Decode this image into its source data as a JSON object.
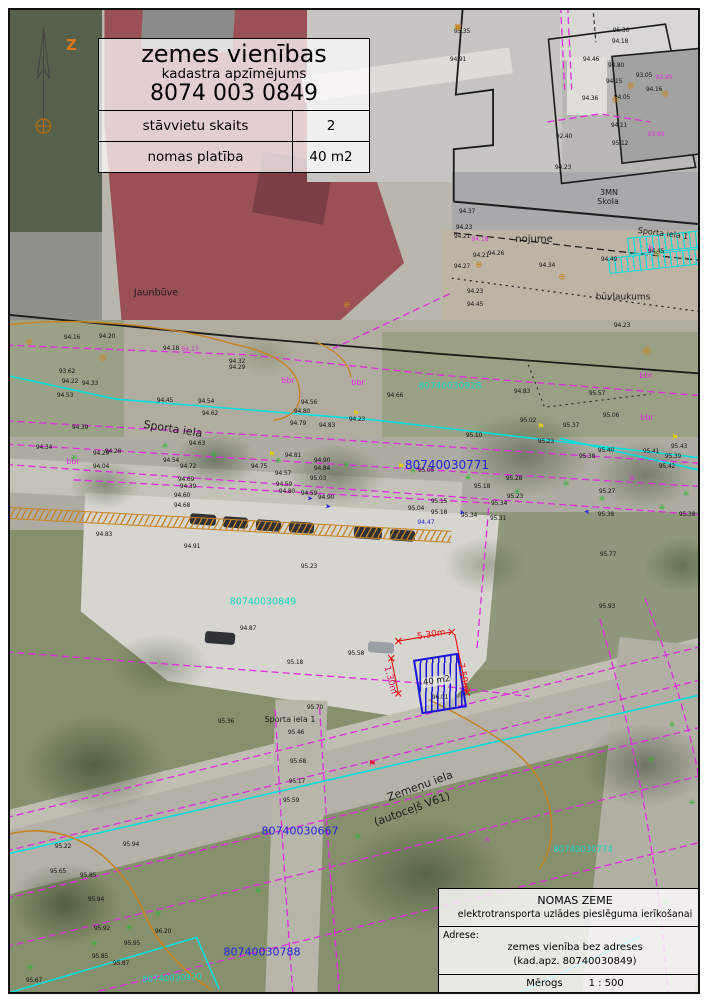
{
  "title_block": {
    "line1": "zemes vienības",
    "line2": "kadastra apzīmējums",
    "line3": "8074 003 0849",
    "rows": [
      {
        "label": "stāvvietu skaits",
        "value": "2"
      },
      {
        "label": "nomas platība",
        "value": "40 m2"
      }
    ]
  },
  "north": {
    "label": "Z"
  },
  "info_block": {
    "title": "NOMAS ZEME",
    "subtitle": "elektrotransporta uzlādes pieslēguma ierīkošanai",
    "address_label": "Adrese:",
    "address_line1": "zemes vienība bez adreses",
    "address_line2": "(kad.apz. 80740030849)",
    "scale_label": "Mērogs",
    "scale_value": "1 : 500"
  },
  "lease_area": {
    "label": "40 m2",
    "dim_top": "5.30m",
    "dim_right": "7.50m",
    "dim_left": "1.30m"
  },
  "colors": {
    "parcel_magenta": "#e02ce0",
    "utility_cyan": "#00dede",
    "contour_orange": "#c8831e",
    "parcel_number_blue": "#2222dd",
    "parcel_number_cyan": "#12d8c8",
    "dimension_red": "#ee1111",
    "lease_blue": "#1616dd",
    "tree_green": "#28b828",
    "north_orange": "#e07818"
  },
  "icons": {
    "tree": "✳",
    "manhole": "⊕",
    "utility_box": "▣",
    "lamp": "⚑",
    "arrow": "➤",
    "hydrant": "⚑"
  },
  "map": {
    "street_labels": [
      {
        "t": "Jaunbūve",
        "x": 146,
        "y": 283,
        "size": 9.5
      },
      {
        "t": "nojume",
        "x": 524,
        "y": 230,
        "size": 10
      },
      {
        "t": "3MN",
        "x": 599,
        "y": 183,
        "size": 8
      },
      {
        "t": "Skola",
        "x": 598,
        "y": 192,
        "size": 8
      },
      {
        "t": "Sporta iela 1",
        "x": 653,
        "y": 224,
        "size": 8,
        "rot": 7
      },
      {
        "t": "būvlaukums",
        "x": 613,
        "y": 288,
        "size": 9
      },
      {
        "t": "Sporta iela",
        "x": 163,
        "y": 419,
        "size": 11,
        "rot": 9
      },
      {
        "t": "Sporta iela 1",
        "x": 280,
        "y": 710,
        "size": 8
      },
      {
        "t": "Zemeņu iela",
        "x": 410,
        "y": 776,
        "size": 11,
        "rot": -20
      },
      {
        "t": "(autoceļš V61)",
        "x": 402,
        "y": 799,
        "size": 11,
        "rot": -20
      }
    ],
    "blue_parcel_numbers": [
      {
        "t": "80740030771",
        "x": 437,
        "y": 455,
        "size": 12
      },
      {
        "t": "80740030667",
        "x": 290,
        "y": 821,
        "size": 11
      },
      {
        "t": "80740030788",
        "x": 252,
        "y": 942,
        "size": 11
      }
    ],
    "cyan_parcel_numbers": [
      {
        "t": "80740030928",
        "x": 440,
        "y": 377
      },
      {
        "t": "80740030849",
        "x": 253,
        "y": 592,
        "size": 9.5
      },
      {
        "t": "80740030774",
        "x": 573,
        "y": 840,
        "size": 8.5
      },
      {
        "t": "80740030930",
        "x": 162,
        "y": 969,
        "size": 8.5,
        "rot": -3
      }
    ],
    "magenta_notes": [
      {
        "t": "bbr",
        "x": 278,
        "y": 371
      },
      {
        "t": "bbr",
        "x": 348,
        "y": 373
      },
      {
        "t": "bbr",
        "x": 636,
        "y": 366
      },
      {
        "t": "bbr",
        "x": 637,
        "y": 408
      },
      {
        "t": "bbr",
        "x": 63,
        "y": 452
      },
      {
        "t": "b",
        "x": 641,
        "y": 239
      },
      {
        "t": "a",
        "x": 622,
        "y": 468
      },
      {
        "t": "a",
        "x": 477,
        "y": 830
      },
      {
        "t": "94.17",
        "x": 180,
        "y": 340,
        "size": 6
      },
      {
        "t": "94.18",
        "x": 470,
        "y": 230,
        "size": 6
      },
      {
        "t": "93.99",
        "x": 646,
        "y": 125,
        "size": 6
      },
      {
        "t": "92.95",
        "x": 654,
        "y": 68,
        "size": 6
      }
    ],
    "blue_notes": [
      {
        "t": "94.47",
        "x": 416,
        "y": 513
      }
    ],
    "elevations": [
      {
        "t": "95.35",
        "x": 452,
        "y": 22
      },
      {
        "t": "94.91",
        "x": 448,
        "y": 50
      },
      {
        "t": "95.36",
        "x": 611,
        "y": 21
      },
      {
        "t": "94.18",
        "x": 610,
        "y": 32
      },
      {
        "t": "94.46",
        "x": 581,
        "y": 50
      },
      {
        "t": "94.80",
        "x": 606,
        "y": 56
      },
      {
        "t": "94.15",
        "x": 604,
        "y": 72
      },
      {
        "t": "93.05",
        "x": 634,
        "y": 66
      },
      {
        "t": "94.16",
        "x": 644,
        "y": 80
      },
      {
        "t": "94.05",
        "x": 612,
        "y": 88
      },
      {
        "t": "94.36",
        "x": 580,
        "y": 89
      },
      {
        "t": "94.11",
        "x": 609,
        "y": 116
      },
      {
        "t": "95.12",
        "x": 610,
        "y": 134
      },
      {
        "t": "92.40",
        "x": 554,
        "y": 127
      },
      {
        "t": "94.23",
        "x": 553,
        "y": 158
      },
      {
        "t": "94.37",
        "x": 457,
        "y": 202
      },
      {
        "t": "94.23",
        "x": 454,
        "y": 218
      },
      {
        "t": "94.21",
        "x": 452,
        "y": 227
      },
      {
        "t": "94.27",
        "x": 452,
        "y": 257
      },
      {
        "t": "94.21",
        "x": 471,
        "y": 246
      },
      {
        "t": "94.26",
        "x": 486,
        "y": 244
      },
      {
        "t": "94.34",
        "x": 537,
        "y": 256
      },
      {
        "t": "94.49",
        "x": 599,
        "y": 250
      },
      {
        "t": "94.45",
        "x": 646,
        "y": 242
      },
      {
        "t": "94.23",
        "x": 465,
        "y": 282
      },
      {
        "t": "94.45",
        "x": 465,
        "y": 295
      },
      {
        "t": "94.23",
        "x": 612,
        "y": 316
      },
      {
        "t": "94.16",
        "x": 62,
        "y": 328
      },
      {
        "t": "94.20",
        "x": 97,
        "y": 327
      },
      {
        "t": "94.18",
        "x": 161,
        "y": 339
      },
      {
        "t": "94.32",
        "x": 227,
        "y": 352
      },
      {
        "t": "94.29",
        "x": 227,
        "y": 358
      },
      {
        "t": "93.62",
        "x": 57,
        "y": 362
      },
      {
        "t": "94.22",
        "x": 60,
        "y": 372
      },
      {
        "t": "94.33",
        "x": 80,
        "y": 374
      },
      {
        "t": "94.53",
        "x": 55,
        "y": 386
      },
      {
        "t": "94.39",
        "x": 70,
        "y": 418
      },
      {
        "t": "94.34",
        "x": 34,
        "y": 438
      },
      {
        "t": "94.29",
        "x": 91,
        "y": 444
      },
      {
        "t": "94.28",
        "x": 103,
        "y": 442
      },
      {
        "t": "94.04",
        "x": 91,
        "y": 457
      },
      {
        "t": "94.45",
        "x": 155,
        "y": 391
      },
      {
        "t": "94.54",
        "x": 196,
        "y": 392
      },
      {
        "t": "94.62",
        "x": 200,
        "y": 404
      },
      {
        "t": "94.56",
        "x": 299,
        "y": 393
      },
      {
        "t": "94.80",
        "x": 292,
        "y": 402
      },
      {
        "t": "94.79",
        "x": 288,
        "y": 414
      },
      {
        "t": "94.83",
        "x": 317,
        "y": 416
      },
      {
        "t": "94.23",
        "x": 347,
        "y": 410
      },
      {
        "t": "94.63",
        "x": 187,
        "y": 434
      },
      {
        "t": "94.54",
        "x": 161,
        "y": 451
      },
      {
        "t": "94.72",
        "x": 178,
        "y": 457
      },
      {
        "t": "94.75",
        "x": 249,
        "y": 457
      },
      {
        "t": "94.81",
        "x": 283,
        "y": 446
      },
      {
        "t": "94.90",
        "x": 312,
        "y": 451
      },
      {
        "t": "94.84",
        "x": 312,
        "y": 459
      },
      {
        "t": "94.57",
        "x": 273,
        "y": 464
      },
      {
        "t": "95.03",
        "x": 308,
        "y": 469
      },
      {
        "t": "94.59",
        "x": 274,
        "y": 475
      },
      {
        "t": "94.69",
        "x": 176,
        "y": 470
      },
      {
        "t": "94.39",
        "x": 178,
        "y": 477
      },
      {
        "t": "94.60",
        "x": 172,
        "y": 486
      },
      {
        "t": "94.80",
        "x": 277,
        "y": 482
      },
      {
        "t": "94.59",
        "x": 299,
        "y": 484
      },
      {
        "t": "94.90",
        "x": 316,
        "y": 488
      },
      {
        "t": "94.68",
        "x": 172,
        "y": 496
      },
      {
        "t": "94.66",
        "x": 385,
        "y": 386
      },
      {
        "t": "94.83",
        "x": 512,
        "y": 382
      },
      {
        "t": "95.57",
        "x": 587,
        "y": 384
      },
      {
        "t": "95.06",
        "x": 601,
        "y": 406
      },
      {
        "t": "95.02",
        "x": 518,
        "y": 411
      },
      {
        "t": "95.37",
        "x": 561,
        "y": 416
      },
      {
        "t": "95.10",
        "x": 464,
        "y": 426
      },
      {
        "t": "95.23",
        "x": 536,
        "y": 432
      },
      {
        "t": "95.40",
        "x": 596,
        "y": 441
      },
      {
        "t": "95.41",
        "x": 641,
        "y": 442
      },
      {
        "t": "95.43",
        "x": 669,
        "y": 437
      },
      {
        "t": "95.39",
        "x": 663,
        "y": 447
      },
      {
        "t": "95.38",
        "x": 577,
        "y": 447
      },
      {
        "t": "95.42",
        "x": 657,
        "y": 457
      },
      {
        "t": "95.05",
        "x": 416,
        "y": 461
      },
      {
        "t": "95.28",
        "x": 504,
        "y": 469
      },
      {
        "t": "95.18",
        "x": 472,
        "y": 477
      },
      {
        "t": "95.23",
        "x": 505,
        "y": 487
      },
      {
        "t": "95.34",
        "x": 489,
        "y": 494
      },
      {
        "t": "95.15",
        "x": 429,
        "y": 492
      },
      {
        "t": "95.04",
        "x": 406,
        "y": 499
      },
      {
        "t": "95.18",
        "x": 429,
        "y": 503
      },
      {
        "t": "95.34",
        "x": 459,
        "y": 506
      },
      {
        "t": "95.31",
        "x": 488,
        "y": 509
      },
      {
        "t": "95.27",
        "x": 597,
        "y": 482
      },
      {
        "t": "95.38",
        "x": 596,
        "y": 505
      },
      {
        "t": "95.38",
        "x": 677,
        "y": 505
      },
      {
        "t": "95.77",
        "x": 598,
        "y": 545
      },
      {
        "t": "95.93",
        "x": 597,
        "y": 597
      },
      {
        "t": "94.83",
        "x": 94,
        "y": 525
      },
      {
        "t": "94.91",
        "x": 182,
        "y": 537
      },
      {
        "t": "95.23",
        "x": 299,
        "y": 557
      },
      {
        "t": "94.87",
        "x": 238,
        "y": 619
      },
      {
        "t": "95.18",
        "x": 285,
        "y": 653
      },
      {
        "t": "95.58",
        "x": 346,
        "y": 644
      },
      {
        "t": "95.70",
        "x": 305,
        "y": 698
      },
      {
        "t": "95.36",
        "x": 216,
        "y": 712
      },
      {
        "t": "95.46",
        "x": 286,
        "y": 723
      },
      {
        "t": "96.01",
        "x": 430,
        "y": 688
      },
      {
        "t": "95.68",
        "x": 288,
        "y": 752
      },
      {
        "t": "95.17",
        "x": 287,
        "y": 772
      },
      {
        "t": "95.59",
        "x": 281,
        "y": 791
      },
      {
        "t": "95.22",
        "x": 53,
        "y": 837
      },
      {
        "t": "95.94",
        "x": 121,
        "y": 835
      },
      {
        "t": "95.65",
        "x": 48,
        "y": 862
      },
      {
        "t": "95.85",
        "x": 78,
        "y": 866
      },
      {
        "t": "95.94",
        "x": 86,
        "y": 890
      },
      {
        "t": "95.92",
        "x": 92,
        "y": 919
      },
      {
        "t": "96.20",
        "x": 153,
        "y": 922
      },
      {
        "t": "95.95",
        "x": 122,
        "y": 934
      },
      {
        "t": "95.85",
        "x": 90,
        "y": 947
      },
      {
        "t": "95.87",
        "x": 111,
        "y": 954
      },
      {
        "t": "95.67",
        "x": 24,
        "y": 971
      }
    ],
    "trees": [
      {
        "x": 64,
        "y": 449
      },
      {
        "x": 155,
        "y": 437
      },
      {
        "x": 204,
        "y": 446
      },
      {
        "x": 268,
        "y": 452
      },
      {
        "x": 336,
        "y": 456
      },
      {
        "x": 403,
        "y": 462
      },
      {
        "x": 458,
        "y": 469
      },
      {
        "x": 507,
        "y": 483
      },
      {
        "x": 556,
        "y": 475
      },
      {
        "x": 592,
        "y": 490
      },
      {
        "x": 652,
        "y": 499
      },
      {
        "x": 676,
        "y": 485
      },
      {
        "x": 20,
        "y": 959
      },
      {
        "x": 84,
        "y": 935
      },
      {
        "x": 119,
        "y": 919
      },
      {
        "x": 148,
        "y": 905
      },
      {
        "x": 248,
        "y": 882
      },
      {
        "x": 348,
        "y": 828
      },
      {
        "x": 662,
        "y": 716
      },
      {
        "x": 693,
        "y": 706
      },
      {
        "x": 641,
        "y": 751
      },
      {
        "x": 682,
        "y": 794
      },
      {
        "x": 656,
        "y": 894
      }
    ],
    "manholes": [
      {
        "x": 19,
        "y": 333
      },
      {
        "x": 93,
        "y": 349
      },
      {
        "x": 337,
        "y": 296
      },
      {
        "x": 469,
        "y": 256
      },
      {
        "x": 552,
        "y": 268
      },
      {
        "x": 621,
        "y": 77
      },
      {
        "x": 655,
        "y": 85
      },
      {
        "x": 605,
        "y": 91
      },
      {
        "x": 637,
        "y": 341,
        "size": 12
      },
      {
        "x": 647,
        "y": 245
      }
    ],
    "utility_boxes": [
      {
        "x": 448,
        "y": 17
      }
    ],
    "lamps": [
      {
        "x": 346,
        "y": 404
      },
      {
        "x": 262,
        "y": 445
      },
      {
        "x": 531,
        "y": 417
      },
      {
        "x": 391,
        "y": 457
      },
      {
        "x": 665,
        "y": 428
      }
    ],
    "flow_arrows": [
      {
        "x": 300,
        "y": 489,
        "rot": 8
      },
      {
        "x": 318,
        "y": 497,
        "rot": 8
      },
      {
        "x": 452,
        "y": 503,
        "rot": 8
      },
      {
        "x": 577,
        "y": 501,
        "rot": -172
      }
    ],
    "hydrants": [
      {
        "x": 362,
        "y": 755
      }
    ]
  }
}
